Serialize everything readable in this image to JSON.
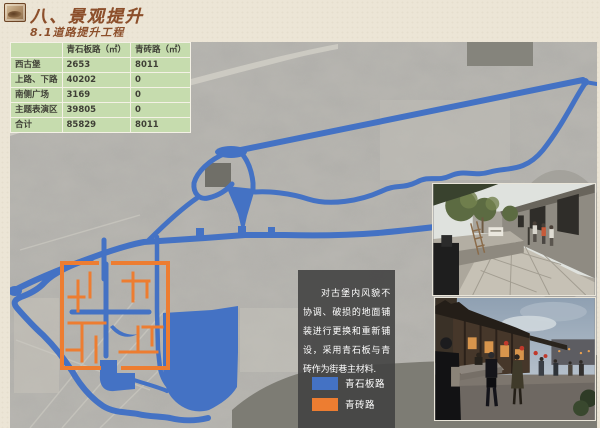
{
  "header": {
    "title": "八、景观提升",
    "subtitle": "8.1道路提升工程"
  },
  "table": {
    "headers": [
      "",
      "青石板路（㎡）",
      "青砖路（㎡）"
    ],
    "rows": [
      [
        "西古堡",
        "2653",
        "8011"
      ],
      [
        "上路、下路",
        "40202",
        "0"
      ],
      [
        "南侧广场",
        "3169",
        "0"
      ],
      [
        "主题表演区",
        "39805",
        "0"
      ],
      [
        "合计",
        "85829",
        "8011"
      ]
    ]
  },
  "textbox": {
    "paragraph": "对古堡内风貌不协调、破损的地面铺装进行更换和重新铺设，采用青石板与青砖作为街巷主材料."
  },
  "legend": {
    "items": [
      {
        "label": "青石板路",
        "color": "#4472c4"
      },
      {
        "label": "青砖路",
        "color": "#ed7d31"
      }
    ]
  },
  "map": {
    "description": "蔚县暖泉镇灰度航拍图，蓝色为青石板路线路，橙色为西古堡青砖路街巷",
    "overlay_colors": {
      "stone_road": "#4472c4",
      "brick_road": "#ed7d31"
    }
  },
  "colors": {
    "title_brown": "#8c4f2b",
    "table_green": "#c6dcae",
    "slide_background": "#ece5d6",
    "notebox_background": "#424242"
  }
}
